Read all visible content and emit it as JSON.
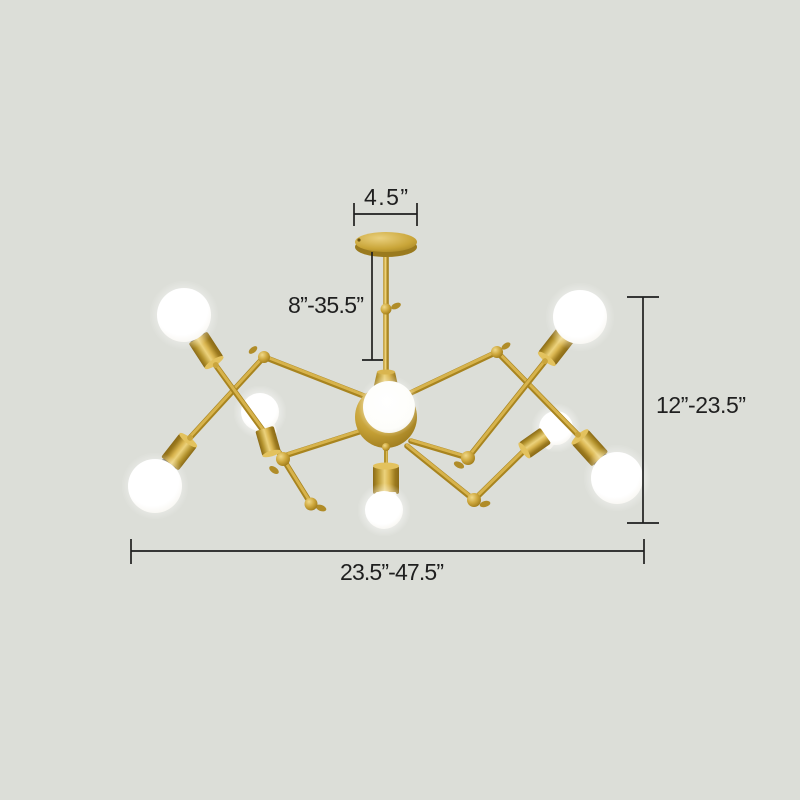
{
  "page": {
    "background": "#dcded8"
  },
  "figure": {
    "kind": "product dimension diagram",
    "subject": "8-light adjustable gold spider chandelier with white globe bulbs",
    "colors": {
      "background": "#dcded8",
      "gold": "#c9a538",
      "gold_light": "#ecd27c",
      "gold_dark": "#8a6a17",
      "bulb_white": "#ffffff",
      "annotation_ink": "#1f1f1f"
    },
    "annotations": {
      "canopy_width": "4.5”",
      "drop_height": "8”-35.5”",
      "fixture_height": "12”-23.5”",
      "fixture_width": "23.5”-47.5”"
    }
  }
}
